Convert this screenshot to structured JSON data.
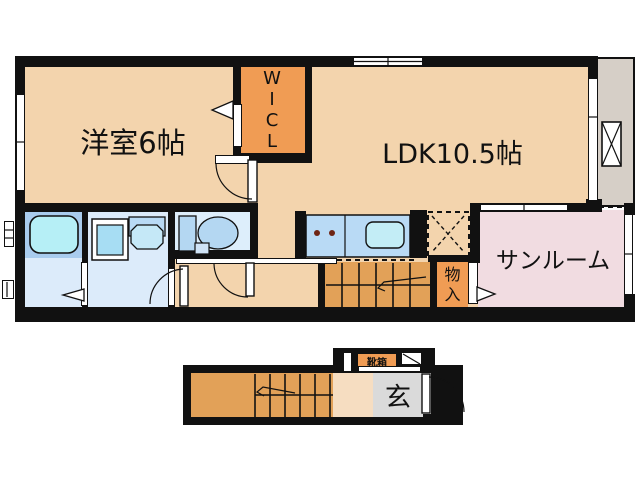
{
  "floor2": {
    "western_room_label": "洋室6帖",
    "ldk_label": "LDK10.5帖",
    "wicl_letters": [
      "W",
      "I",
      "C",
      "L"
    ],
    "sunroom_label": "サンルーム",
    "storage_letters": [
      "物",
      "入"
    ],
    "fixtures": [
      "bathtub",
      "washing-machine",
      "washbasin",
      "toilet",
      "kitchen-counter",
      "sink",
      "refrigerator-space",
      "staircase"
    ]
  },
  "floor1": {
    "shoebox_label": "靴箱",
    "genkan_label": "玄",
    "fixtures": [
      "staircase",
      "entrance-door"
    ]
  },
  "colors": {
    "floor_peach": "#f3d4ad",
    "closet_orange": "#f09c54",
    "stairs_orange": "#e2a158",
    "sunroom_pink": "#f1dce1",
    "balcony_gray": "#d6cfc7",
    "genkan_gray": "#dadada",
    "wall_black": "#111111",
    "bath_surround": "#a9ccee",
    "bathtub_cyan": "#b6eff6",
    "wet_room_blue": "#dcebfa",
    "counter_blue": "#b9daf5",
    "sink_cyan": "#c3edf6",
    "fixture_blue": "#b4d7f2",
    "burner_brown": "#6e2413"
  }
}
